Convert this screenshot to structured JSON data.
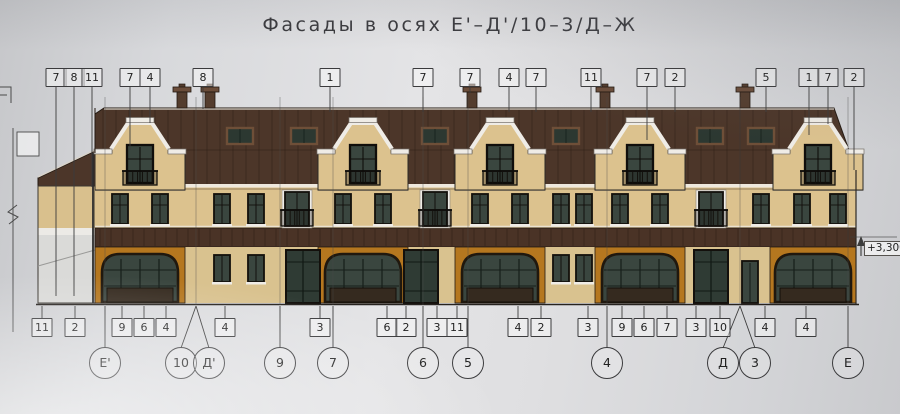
{
  "title": "Фасады в осях Е'–Д'/10–3/Д–Ж",
  "elevation_mark": "+3,300",
  "colors": {
    "roof": "#4c3629",
    "wall": "#dcc28e",
    "orange": "#b5771f",
    "band": "#4a3326",
    "glass": "#3a463f",
    "trim": "#efece6",
    "ink": "#3a3a3c"
  },
  "top_callouts": [
    {
      "label": "7",
      "x": 56,
      "end": 296
    },
    {
      "label": "8",
      "x": 74,
      "end": 296
    },
    {
      "label": "11",
      "x": 92,
      "end": 187
    },
    {
      "label": "7",
      "x": 130,
      "end": 150
    },
    {
      "label": "4",
      "x": 150,
      "end": 123
    },
    {
      "label": "8",
      "x": 203,
      "end": 109
    },
    {
      "label": "1",
      "x": 330,
      "end": 112
    },
    {
      "label": "7",
      "x": 423,
      "end": 112
    },
    {
      "label": "7",
      "x": 470,
      "end": 93
    },
    {
      "label": "4",
      "x": 509,
      "end": 112
    },
    {
      "label": "7",
      "x": 536,
      "end": 112
    },
    {
      "label": "11",
      "x": 591,
      "end": 112
    },
    {
      "label": "7",
      "x": 647,
      "end": 140
    },
    {
      "label": "2",
      "x": 675,
      "end": 112
    },
    {
      "label": "5",
      "x": 766,
      "end": 112
    },
    {
      "label": "1",
      "x": 809,
      "end": 135
    },
    {
      "label": "7",
      "x": 828,
      "end": 124
    },
    {
      "label": "2",
      "x": 854,
      "end": 170
    }
  ],
  "bottom_callouts": [
    {
      "label": "11",
      "x": 42
    },
    {
      "label": "2",
      "x": 75
    },
    {
      "label": "9",
      "x": 122
    },
    {
      "label": "6",
      "x": 144
    },
    {
      "label": "4",
      "x": 166
    },
    {
      "label": "4",
      "x": 225
    },
    {
      "label": "3",
      "x": 320
    },
    {
      "label": "6",
      "x": 387
    },
    {
      "label": "2",
      "x": 406
    },
    {
      "label": "3",
      "x": 437
    },
    {
      "label": "11",
      "x": 457
    },
    {
      "label": "4",
      "x": 518
    },
    {
      "label": "2",
      "x": 541
    },
    {
      "label": "3",
      "x": 588
    },
    {
      "label": "9",
      "x": 622
    },
    {
      "label": "6",
      "x": 644
    },
    {
      "label": "7",
      "x": 667
    },
    {
      "label": "3",
      "x": 696
    },
    {
      "label": "10",
      "x": 720
    },
    {
      "label": "4",
      "x": 765
    },
    {
      "label": "4",
      "x": 806
    }
  ],
  "axis_circles": [
    {
      "label": "Е'",
      "x": 105,
      "tx": 105
    },
    {
      "label": "10",
      "x": 181,
      "tx": 196
    },
    {
      "label": "Д'",
      "x": 209,
      "tx": 196
    },
    {
      "label": "9",
      "x": 280,
      "tx": 280
    },
    {
      "label": "7",
      "x": 333,
      "tx": 333
    },
    {
      "label": "6",
      "x": 423,
      "tx": 423
    },
    {
      "label": "5",
      "x": 468,
      "tx": 468
    },
    {
      "label": "4",
      "x": 607,
      "tx": 607
    },
    {
      "label": "Д",
      "x": 723,
      "tx": 740
    },
    {
      "label": "3",
      "x": 755,
      "tx": 740
    },
    {
      "label": "Е",
      "x": 848,
      "tx": 848
    }
  ],
  "facade": {
    "gables": [
      140,
      363,
      500,
      640,
      818
    ],
    "chimneys": [
      182,
      210,
      472,
      605,
      745
    ],
    "attic_windows": [
      240,
      304,
      435,
      566,
      710,
      761
    ],
    "upper_windows": [
      120,
      160,
      222,
      256,
      343,
      383,
      480,
      520,
      561,
      584,
      620,
      660,
      761,
      802,
      838
    ],
    "balcony_doors": [
      297,
      435,
      711
    ],
    "orange": [
      [
        95,
        185
      ],
      [
        318,
        408
      ],
      [
        455,
        545
      ],
      [
        595,
        685
      ],
      [
        770,
        856
      ]
    ],
    "arches": [
      140,
      363,
      500,
      640,
      813
    ],
    "ground_windows": [
      222,
      256,
      561,
      584
    ],
    "ground_glazed": [
      303,
      421,
      711
    ],
    "door": 750
  }
}
